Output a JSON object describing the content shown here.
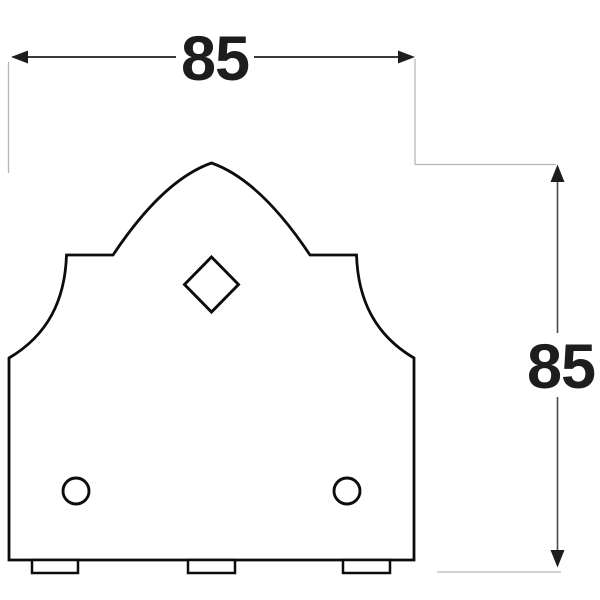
{
  "diagram": {
    "type": "technical-drawing-front-view",
    "part": "ornamental-bracket-plate",
    "labels": {
      "width": "85",
      "height": "85"
    },
    "features": {
      "diamond_hole": "square hole rotated 45 deg, centered under apex",
      "round_holes": "two circular holes near bottom corners",
      "bottom_tabs": "three rectangular tabs protruding below bottom edge"
    },
    "colors": {
      "background": "#ffffff",
      "outline": "#0c0c0c",
      "dimension_line": "#3a3a3a",
      "extension_line": "#b6b6b6",
      "label_text": "#1d1d1d"
    }
  }
}
